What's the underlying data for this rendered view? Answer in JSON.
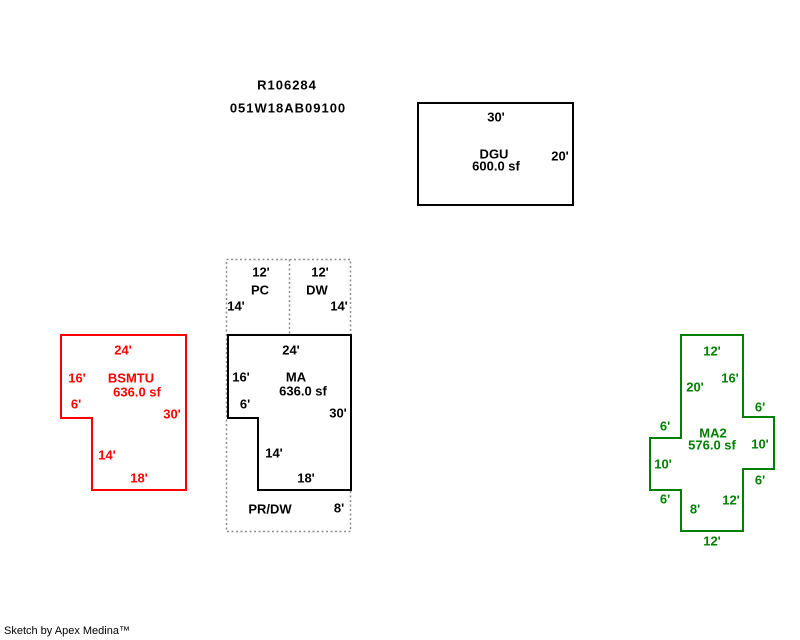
{
  "title": {
    "line1": "R106284",
    "line2": "051W18AB09100"
  },
  "colors": {
    "black": "#000000",
    "red": "#ff0000",
    "green": "#008000",
    "dotted": "#8c8c8c",
    "white": "#ffffff"
  },
  "areas": {
    "dgu": {
      "name": "DGU",
      "sqft": "600.0 sf",
      "dims": {
        "top": "30'",
        "right": "20'"
      }
    },
    "pc": {
      "name": "PC",
      "dims": {
        "top": "12'",
        "left": "14'"
      }
    },
    "dw": {
      "name": "DW",
      "dims": {
        "top": "12'",
        "right": "14'"
      }
    },
    "ma": {
      "name": "MA",
      "sqft": "636.0 sf",
      "dims": {
        "top": "24'",
        "left": "16'",
        "step": "6'",
        "right": "30'",
        "inner": "14'",
        "bottom": "18'"
      }
    },
    "prdw": {
      "name": "PR/DW",
      "dims": {
        "right": "8'"
      }
    },
    "bsmtu": {
      "name": "BSMTU",
      "sqft": "636.0 sf",
      "dims": {
        "top": "24'",
        "left": "16'",
        "step": "6'",
        "right": "30'",
        "inner": "14'",
        "bottom": "18'"
      }
    },
    "ma2": {
      "name": "MA2",
      "sqft": "576.0 sf",
      "dims": {
        "top": "12'",
        "upper_right": "16'",
        "upper_left": "20'",
        "right_arm_top": "6'",
        "left_arm_top": "6'",
        "right_arm_side": "10'",
        "left_arm_side": "10'",
        "right_arm_bottom": "6'",
        "left_arm_bottom": "6'",
        "stem_right": "12'",
        "stem_left": "8'",
        "bottom": "12'"
      }
    }
  },
  "footer": {
    "credit": "Sketch by Apex Medina™"
  }
}
